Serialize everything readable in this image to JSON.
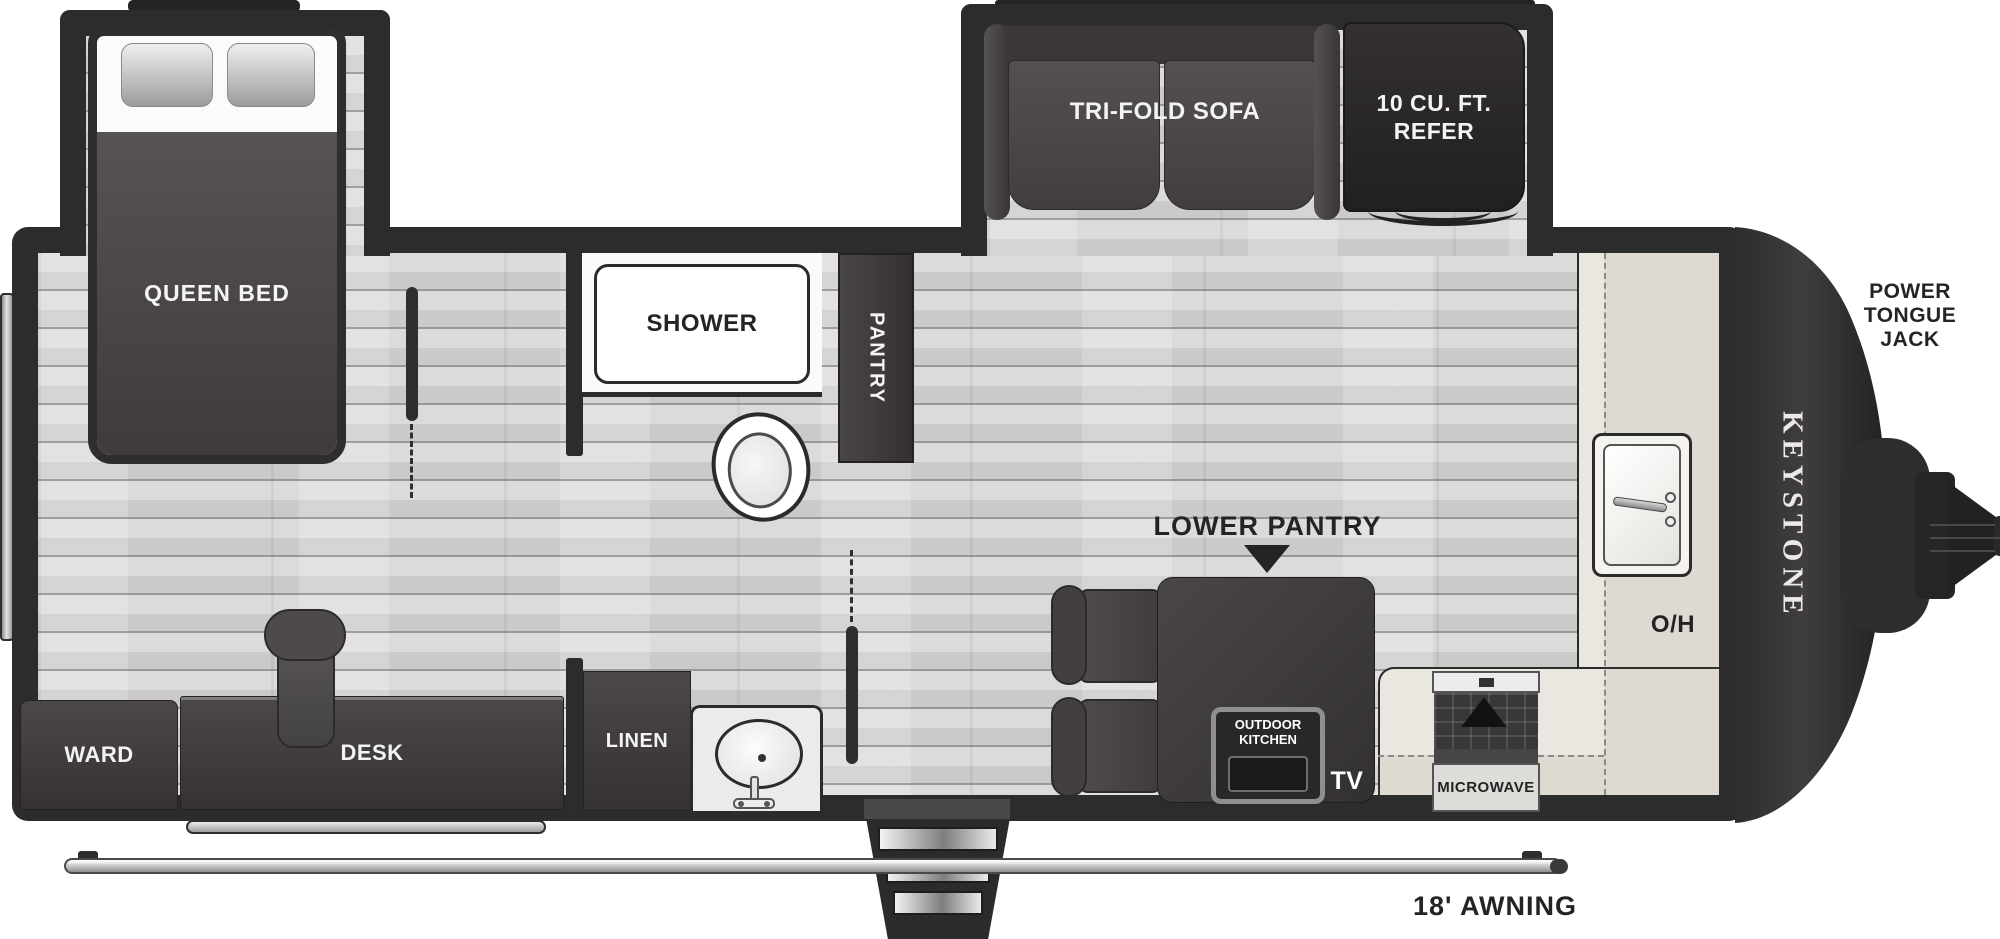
{
  "floorplan": {
    "brand": "KEYSTONE",
    "labels": {
      "queen_bed": "QUEEN BED",
      "shower": "SHOWER",
      "pantry": "PANTRY",
      "tri_fold_sofa": "TRI-FOLD SOFA",
      "refrigerator": "10 CU. FT. REFER",
      "power_tongue_jack": "POWER TONGUE JACK",
      "overhead_cabinet": "O/H",
      "lower_pantry": "LOWER PANTRY",
      "outdoor_kitchen": "OUTDOOR KITCHEN",
      "tv": "TV",
      "microwave": "MICROWAVE",
      "ward": "WARD",
      "desk": "DESK",
      "linen": "LINEN",
      "awning": "18' AWNING"
    },
    "colors": {
      "wall": "#2c2c2c",
      "furniture_dark": "#423e40",
      "floor": "#d6d5d4",
      "counter": "#eae7e0",
      "label_dark": "#242424",
      "label_light": "#f5f5f5"
    }
  }
}
